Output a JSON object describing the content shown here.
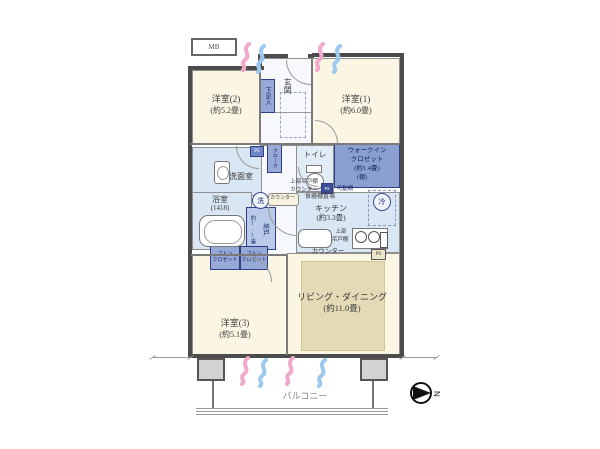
{
  "plan": {
    "mb": "MB",
    "compass_n": "N",
    "balcony": "バルコニー",
    "rooms": {
      "western2": {
        "name": "洋室(2)",
        "size": "(約5.2畳)"
      },
      "western1": {
        "name": "洋室(1)",
        "size": "(約6.0畳)"
      },
      "western3": {
        "name": "洋室(3)",
        "size": "(約5.1畳)"
      },
      "living": {
        "name": "リビング・ダイニング",
        "size": "(約11.0畳)"
      },
      "kitchen": {
        "name": "キッチン",
        "size": "(約3.3畳)",
        "shelf_space": "食器棚置場",
        "upper_cabinet_line1": "上部",
        "upper_cabinet_line2": "吊戸棚",
        "counter": "カウンター"
      },
      "entrance": "玄関",
      "washroom": "洗面室",
      "bathroom": {
        "name": "浴室",
        "size": "(1418)"
      },
      "toilet": "トイレ",
      "wic": {
        "line1": "ウォークイン",
        "line2": "クロゼット",
        "size": "(約1.4畳)",
        "shelf": "(棚)"
      },
      "storeroom": {
        "name": "納戸",
        "size": "約1.1畳"
      },
      "futon_closet_left": {
        "line1": "フトン",
        "line2": "クロゼット"
      },
      "futon_closet_right": {
        "line1": "フトン",
        "line2": "クロゼット"
      },
      "shoe_cabinet": "下足入",
      "cloak": "クローク"
    },
    "fixtures": {
      "washer": "洗",
      "fridge": "冷",
      "ps_top": "PS",
      "ps_mid": "PS",
      "ps_kitchen": "PS",
      "hall_counter": "カウンター",
      "hatch_upper_cabinet": "上部吊戸棚",
      "hatch_counter": "カウンター",
      "movable_shelf": "可動棚"
    },
    "colors": {
      "room_cream": "#FBF6E3",
      "wet_blue": "#D9E6F3",
      "cabinet_blue": "#97A9D6",
      "wic_blue": "#8BA0CF",
      "rug_tan": "#E4DAB6",
      "airflow_pink": "#F0A9CB",
      "airflow_blue": "#9CC9F0",
      "wall": "#4C4C4C"
    }
  }
}
